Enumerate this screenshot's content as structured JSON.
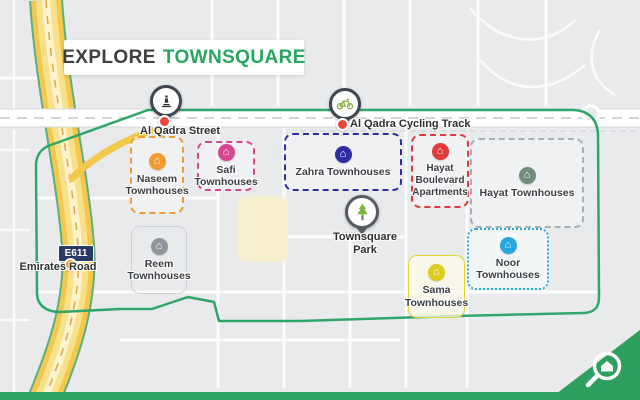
{
  "title": {
    "prefix": "EXPLORE",
    "highlight": "TOWNSQUARE"
  },
  "colors": {
    "brand_green": "#27a661",
    "boundary_green": "#2fa56a",
    "map_background": "#e9eaec",
    "highway_yellow": "#f2c94c",
    "badge_navy": "#2b3a64"
  },
  "landmarks": {
    "street_label": "Al Qadra Street",
    "cycling_label": "Al Qadra Cycling Track",
    "highway_badge": "E611",
    "highway_name": "Emirates Road",
    "park_name": "Townsquare Park"
  },
  "regions": [
    {
      "name": "Naseem Townhouses",
      "color": "#f09b30",
      "border_color": "#f09b30"
    },
    {
      "name": "Safi Townhouses",
      "color": "#d8468f",
      "border_color": "#d8468f"
    },
    {
      "name": "Zahra Townhouses",
      "color": "#2e2ea2",
      "border_color": "#2e2ea2"
    },
    {
      "name": "Hayat Boulevard Apartments",
      "color": "#e23a3a",
      "border_color": "#e23a3a"
    },
    {
      "name": "Hayat Townhouses",
      "color": "#6f8e7e",
      "border_color": "#a9afb5"
    },
    {
      "name": "Sama Townhouses",
      "color": "#dfcd1c",
      "border_color": "#e4d52e"
    },
    {
      "name": "Noor Townhouses",
      "color": "#27a7de",
      "border_color": "#27a7de"
    },
    {
      "name": "Reem Townhouses",
      "color": "#90969c",
      "border_color": "#ced1d5"
    }
  ],
  "icons": {
    "home": "⌂",
    "statue": "statue-icon",
    "bicycle": "bicycle-icon",
    "tree": "tree-icon",
    "logo": "bayut-magnifier-home-icon"
  }
}
